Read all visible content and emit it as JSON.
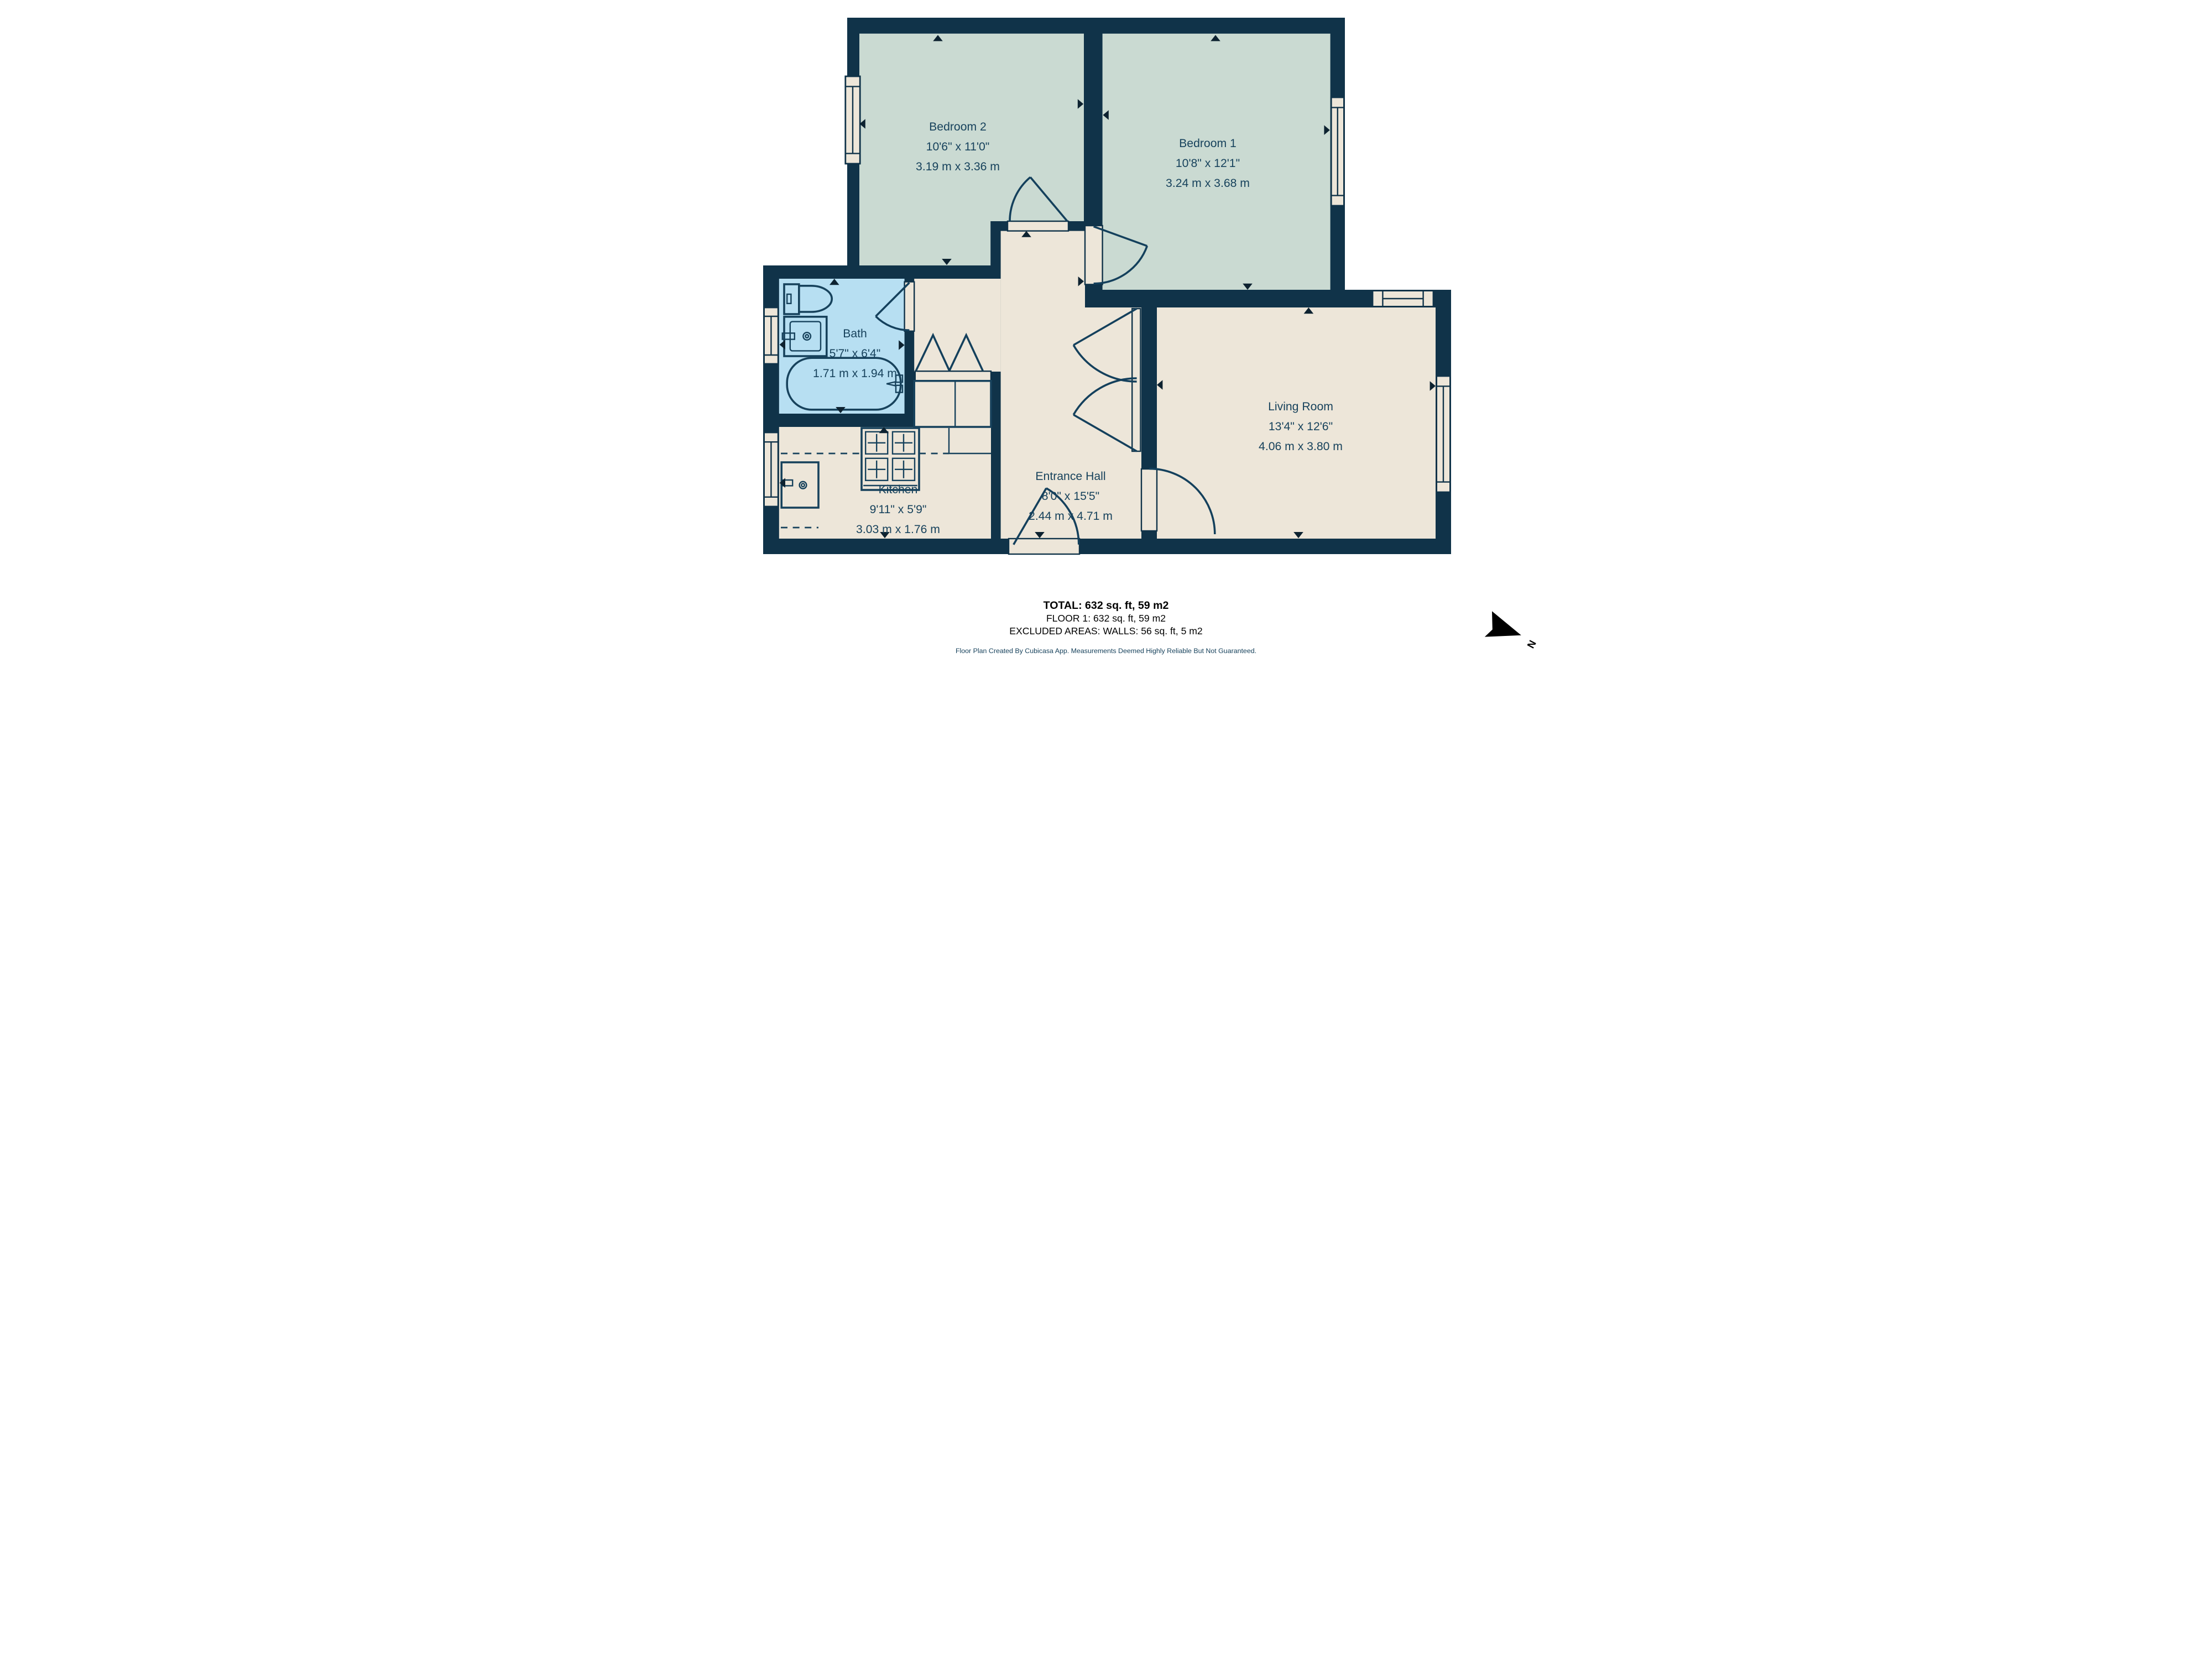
{
  "rooms": [
    {
      "name": "Bedroom 2",
      "imperial": "10'6\" x 11'0\"",
      "metric": "3.19 m x 3.36 m"
    },
    {
      "name": "Bedroom 1",
      "imperial": "10'8\" x 12'1\"",
      "metric": "3.24 m x 3.68 m"
    },
    {
      "name": "Bath",
      "imperial": "5'7\" x 6'4\"",
      "metric": "1.71 m x 1.94 m"
    },
    {
      "name": "Kitchen",
      "imperial": "9'11\" x 5'9\"",
      "metric": "3.03 m x 1.76 m"
    },
    {
      "name": "Entrance Hall",
      "imperial": "8'0\" x 15'5\"",
      "metric": "2.44 m x 4.71 m"
    },
    {
      "name": "Living Room",
      "imperial": "13'4\" x 12'6\"",
      "metric": "4.06 m x 3.80 m"
    }
  ],
  "summary": {
    "total": "TOTAL: 632 sq. ft, 59 m2",
    "floor": "FLOOR 1: 632 sq. ft, 59 m2",
    "excluded": "EXCLUDED AREAS: WALLS: 56 sq. ft, 5 m2"
  },
  "disclaimer": "Floor Plan Created By Cubicasa App. Measurements Deemed Highly Reliable But Not Guaranteed.",
  "compass": {
    "label": "N"
  },
  "colors": {
    "wall": "#103349",
    "bedroom_floor": "#cadad2",
    "bath_floor": "#b7dff2",
    "main_floor": "#ede6d9",
    "label_text": "#17425c"
  }
}
